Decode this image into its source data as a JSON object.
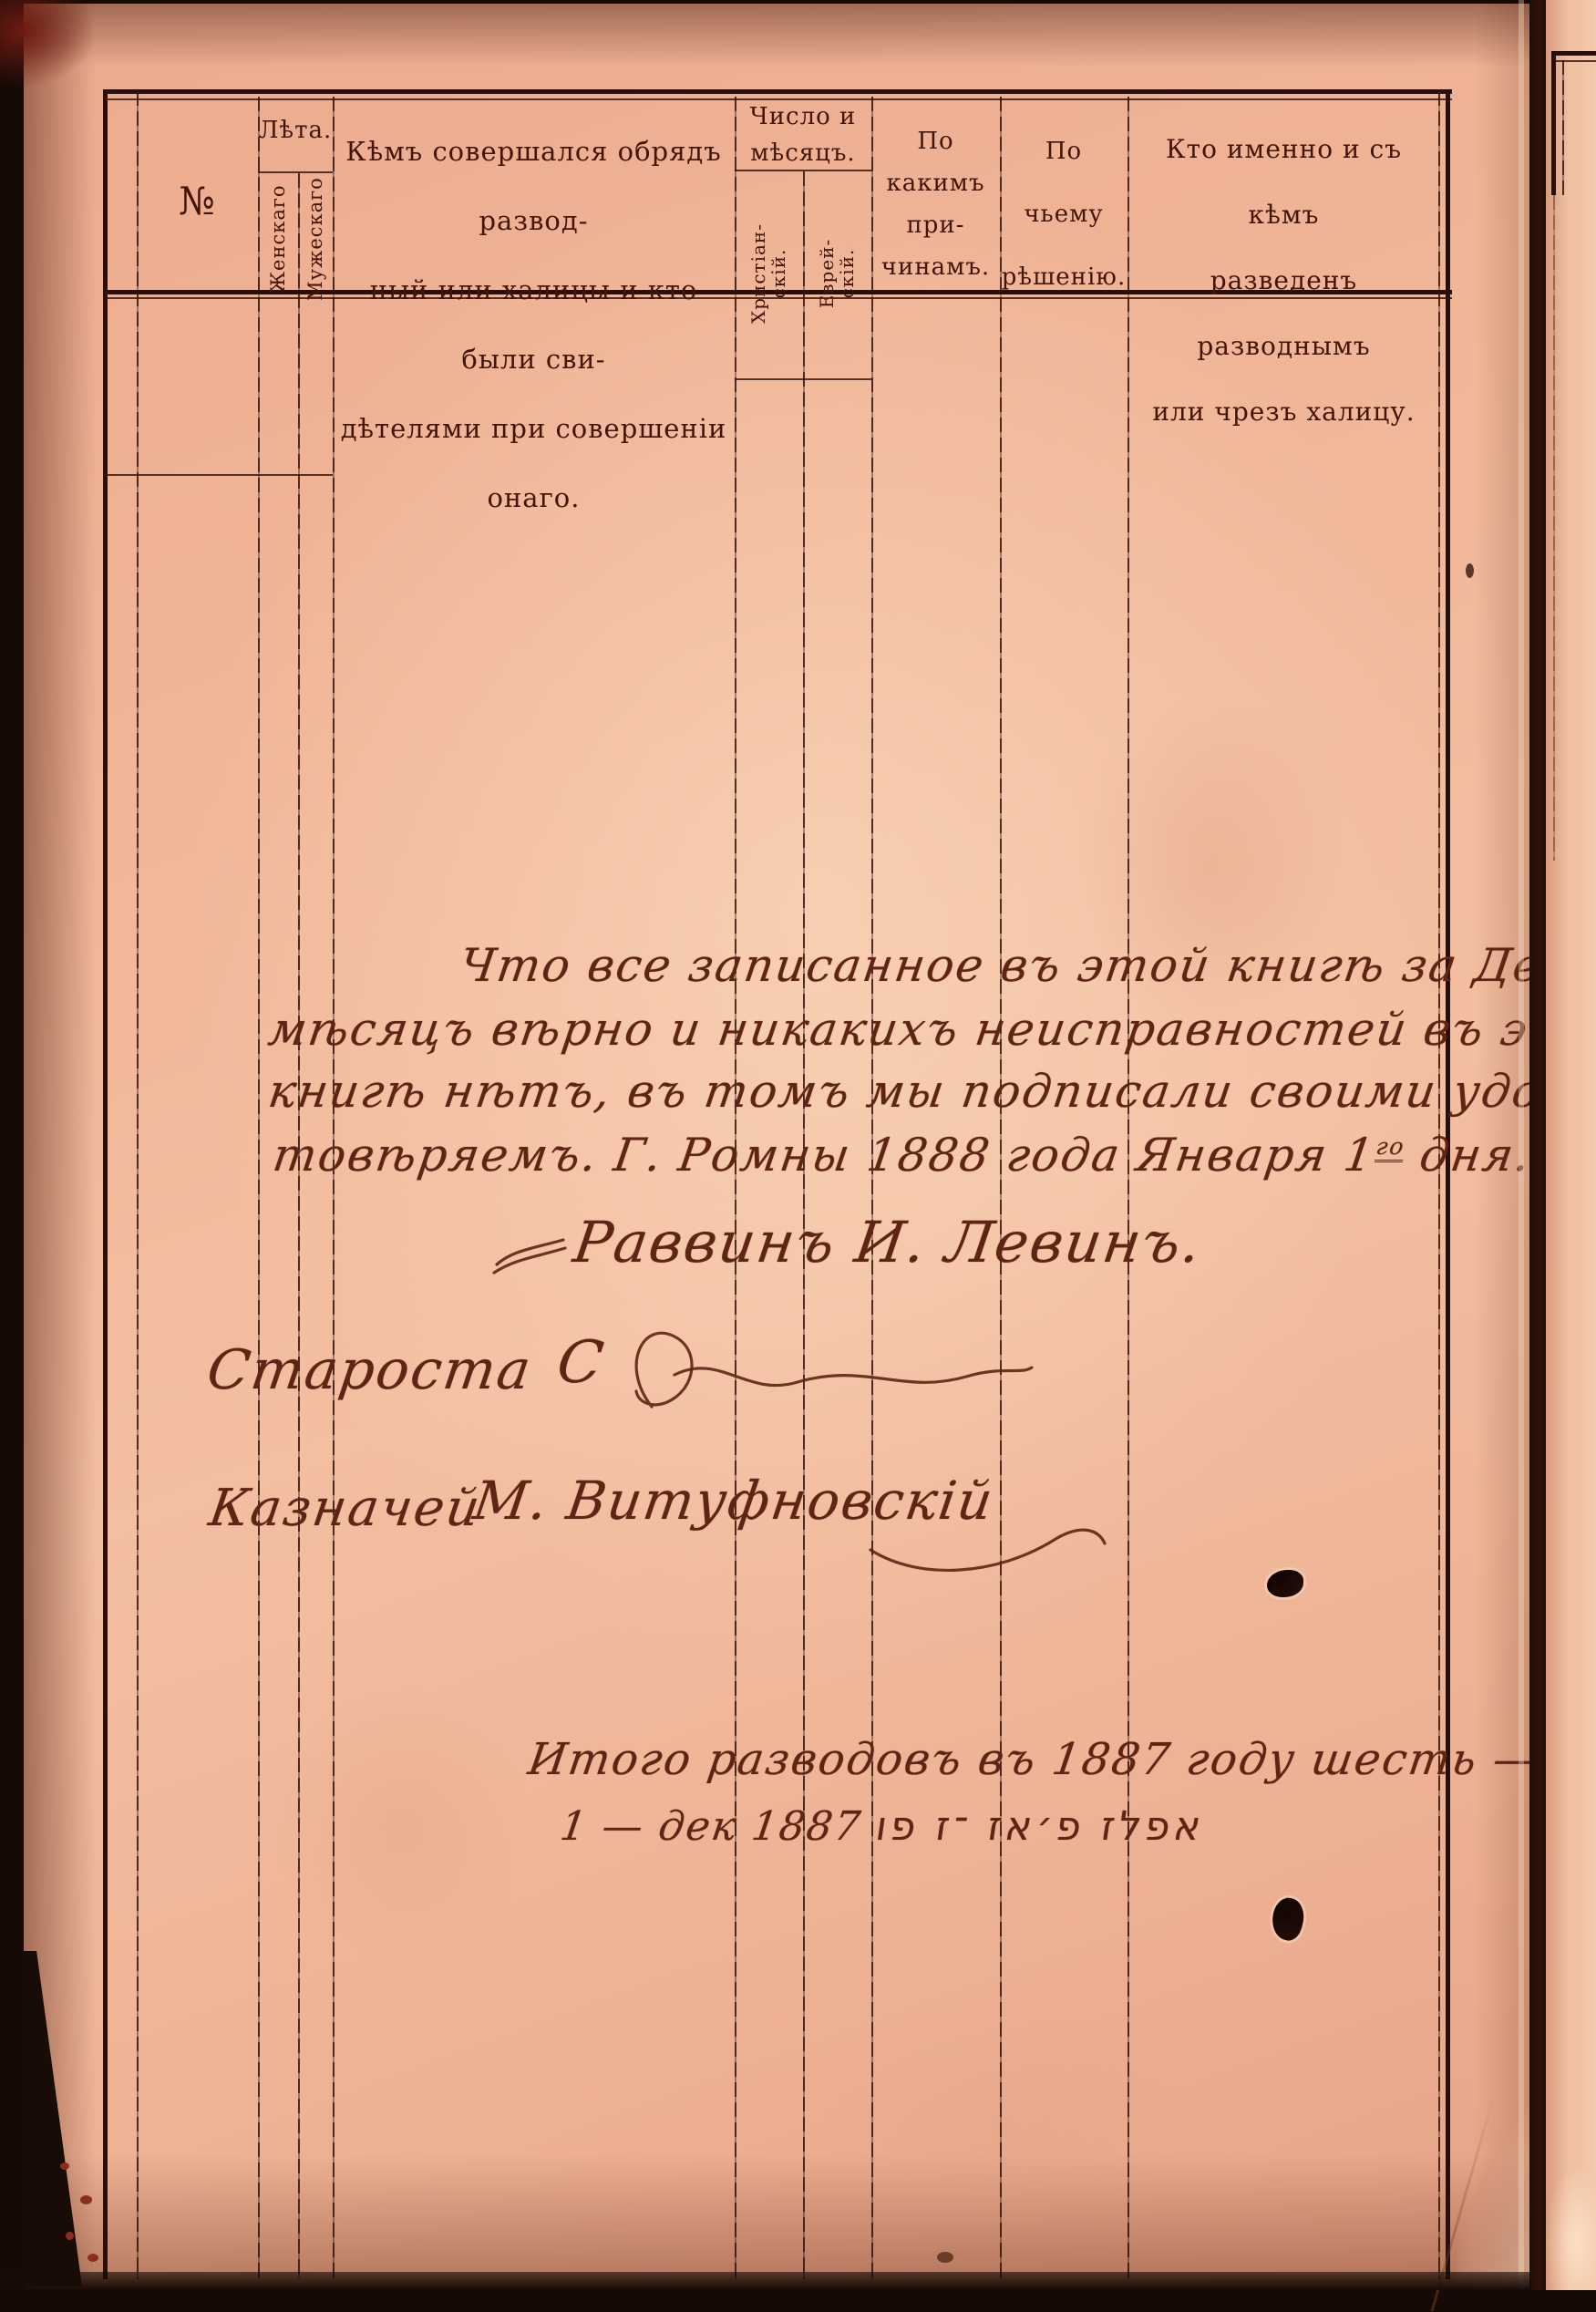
{
  "table": {
    "no": "№",
    "leta": {
      "label": "Лѣта.",
      "left": "Женскаго",
      "right": "Мужескаго"
    },
    "kem": {
      "l1": "Кѣмъ совершался обрядъ развод-",
      "l2": "ный или халицы и кто были сви-",
      "l3": "дѣтелями при совершеніи онаго."
    },
    "chislo": {
      "l1": "Число и",
      "l2": "мѣсяцъ.",
      "christian_l1": "Христіан-",
      "christian_l2": "скій.",
      "jewish_l1": "Еврей-",
      "jewish_l2": "скій."
    },
    "prichina": {
      "l1": "По",
      "l2": "какимъ",
      "l3": "при-",
      "l4": "чинамъ."
    },
    "reshenie": {
      "l1": "По",
      "l2": "чьему",
      "l3": "рѣшенію."
    },
    "kto": {
      "l1": "Кто именно и съ кѣмъ",
      "l2": "разведенъ разводнымъ",
      "l3": "или чрезъ халицу."
    }
  },
  "handwriting": {
    "cert_line1": "Что все записанное въ этой книгѣ за Декабрь",
    "cert_line2": "мѣсяцъ вѣрно и никакихъ неисправностей въ этой",
    "cert_line3": "книгѣ нѣтъ, въ томъ мы подписали своими удос-",
    "cert_line4_a": "товѣряемъ. Г. Ромны 1888 года Января 1",
    "cert_line4_sup": "го",
    "cert_line4_b": " дня. —",
    "rabbi_signature": "Раввинъ И. Левинъ.",
    "starosta_label": "Староста",
    "starosta_sig": "С",
    "treasurer_label": "Казначей",
    "treasurer_sig": "М. Витуфновскій",
    "total_line": "Итого разводовъ въ 1887 году шесть — 6.",
    "date_note_prefix": "1 — дек 1887",
    "date_note_hebrew": "אפלז  פ׳אז  ־ז  פו"
  },
  "colors": {
    "paper": "#f0b697",
    "print_ink": "#431509",
    "handwriting_ink": "#5f2514",
    "rule": "#2b0e07",
    "scan_background": "#150a05"
  }
}
